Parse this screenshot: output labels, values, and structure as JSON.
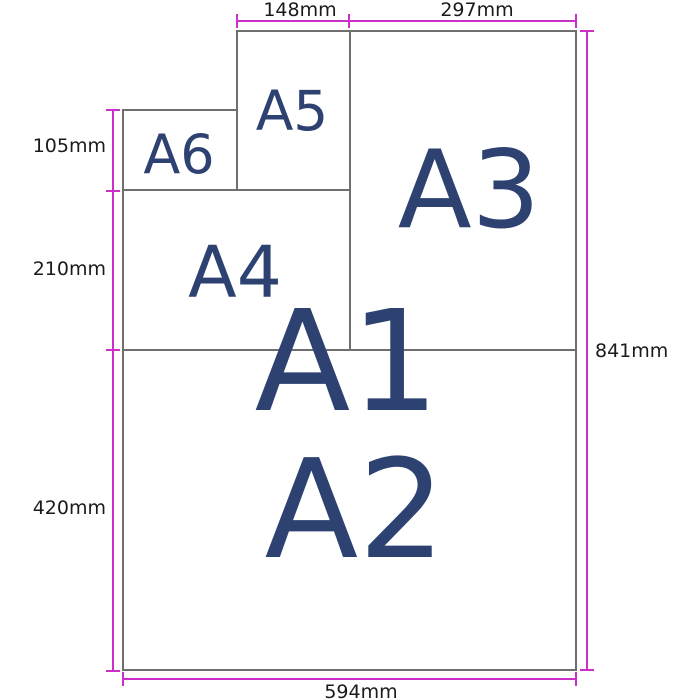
{
  "papers": [
    {
      "id": "a1",
      "label": "A1"
    },
    {
      "id": "a2",
      "label": "A2"
    },
    {
      "id": "a3",
      "label": "A3"
    },
    {
      "id": "a4",
      "label": "A4"
    },
    {
      "id": "a5",
      "label": "A5"
    },
    {
      "id": "a6",
      "label": "A6"
    }
  ],
  "dimensions": {
    "a5_width": "148mm",
    "a3_width": "297mm",
    "a6_height": "105mm",
    "a4_height": "210mm",
    "a2_height": "420mm",
    "a1_height": "841mm",
    "a1_width": "594mm"
  },
  "colors": {
    "background": "#ffffff",
    "paper_fill": "#ffffff",
    "paper_border": "#6f6f6f",
    "dimension_line": "#cc2fc8",
    "size_label_text": "#2e4272",
    "dimension_label_text": "#1a1a1a"
  }
}
